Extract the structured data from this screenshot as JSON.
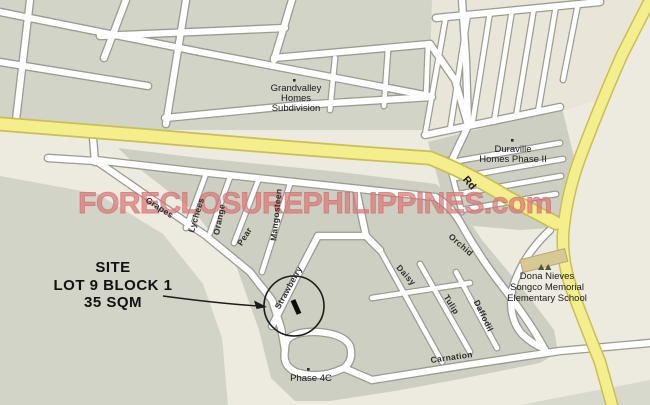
{
  "map": {
    "watermark": "FORECLOSUREPHILIPPINES.com",
    "site_callout": {
      "line1": "SITE",
      "line2": "LOT 9 BLOCK 1",
      "line3": "35 SQM"
    },
    "places": {
      "grandvalley": {
        "line1": "Grandvalley",
        "line2": "Homes",
        "line3": "Subdivision"
      },
      "duraville": {
        "line1": "Duraville",
        "line2": "Homes Phase II"
      },
      "school": {
        "line1": "Dona Nieves",
        "line2": "Songco Memorial",
        "line3": "Elementary School"
      },
      "phase4c": "Phase 4C"
    },
    "roads": {
      "main_road_label": "Rd",
      "streets": {
        "grapes": "Grapes",
        "lychees": "Lychees",
        "orange": "Orange",
        "pear": "Pear",
        "mangosteen": "Mangosteen",
        "strawberry": "Strawberry",
        "orchid": "Orchid",
        "daisy": "Daisy",
        "tulip": "Tulip",
        "daffodil": "Daffodil",
        "carnation": "Carnation"
      }
    },
    "colors": {
      "map-bg": "#edeadf",
      "block-gray": "#d2d4c8",
      "block-gray-dark": "#cccfc2",
      "comb-beige": "#e9e6d9",
      "road-fill": "#ffffff",
      "road-casing": "#9a9b92",
      "highway-fill": "#f5ee8c",
      "highway-casing": "#c9bf53",
      "school-fill": "#d8c994",
      "watermark": "#dd7777",
      "label": "#1a1a1a"
    }
  }
}
